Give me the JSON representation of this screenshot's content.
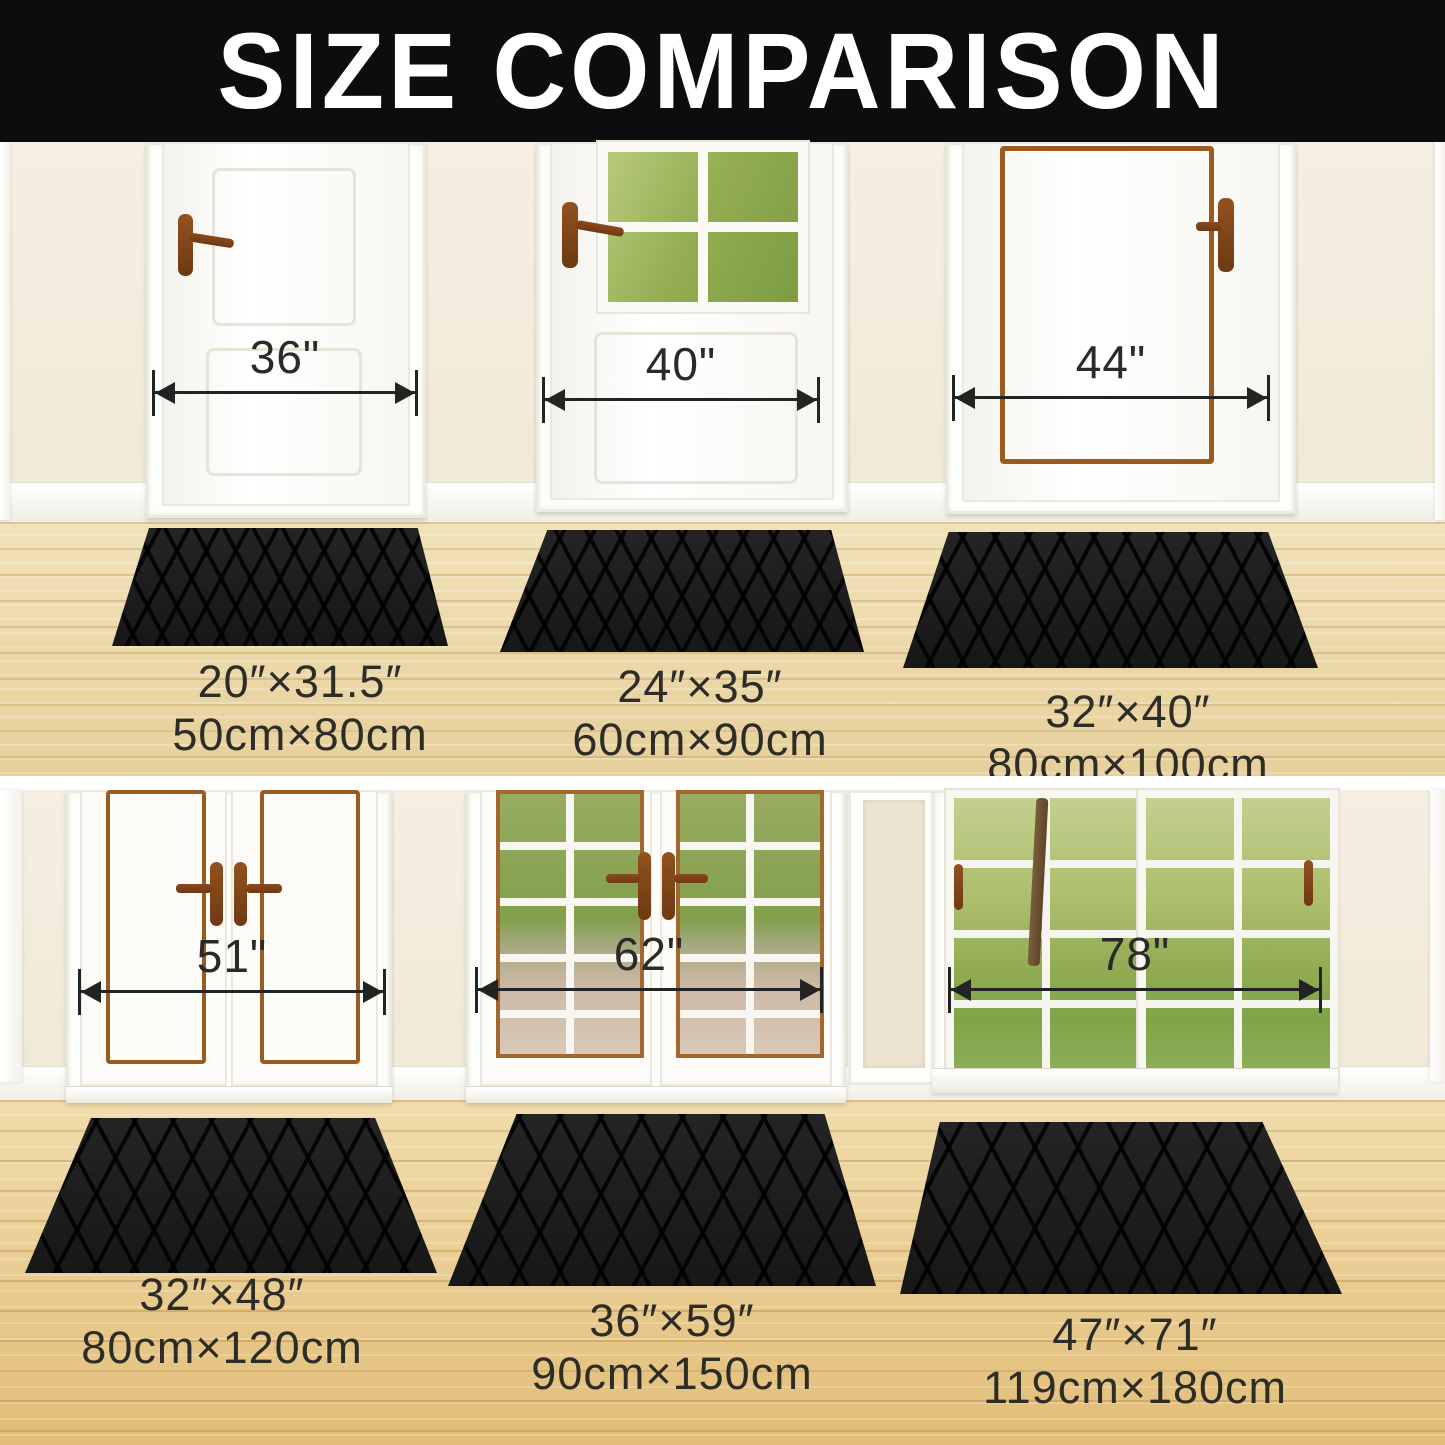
{
  "title": "SIZE COMPARISON",
  "top_row": {
    "doors": [
      {
        "width_label": "36\""
      },
      {
        "width_label": "40\""
      },
      {
        "width_label": "44\""
      }
    ],
    "mats": [
      {
        "inches": "20″×31.5″",
        "cm": "50cm×80cm"
      },
      {
        "inches": "24″×35″",
        "cm": "60cm×90cm"
      },
      {
        "inches": "32″×40″",
        "cm": "80cm×100cm"
      }
    ]
  },
  "bottom_row": {
    "doors": [
      {
        "width_label": "51\""
      },
      {
        "width_label": "62\""
      },
      {
        "width_label": "78\""
      }
    ],
    "mats": [
      {
        "inches": "32″×48″",
        "cm": "80cm×120cm"
      },
      {
        "inches": "36″×59″",
        "cm": "90cm×150cm"
      },
      {
        "inches": "47″×71″",
        "cm": "119cm×180cm"
      }
    ]
  },
  "colors": {
    "banner": "#0d0d0d",
    "title_text": "#ffffff",
    "mat": "#1d1d1d",
    "wall": "#f2ecdd",
    "floor_top": "#ecd9ad",
    "floor_bottom": "#e9cd92",
    "door_trim_brown": "#9a5a20",
    "annotation": "#232323"
  }
}
